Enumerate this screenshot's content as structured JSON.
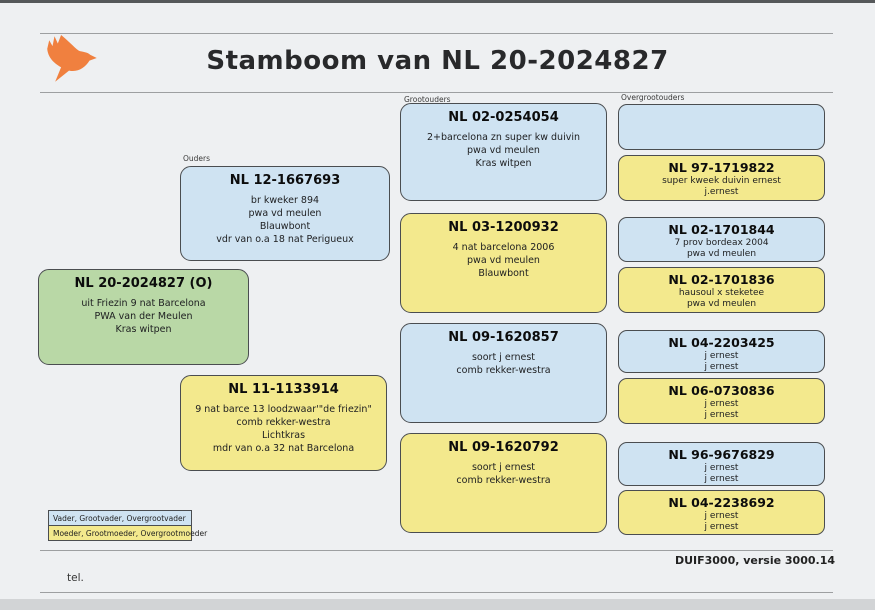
{
  "page": {
    "title": "Stamboom van NL 20-2024827",
    "footer_program": "DUIF3000, versie 3000.14",
    "footer_tel": "tel."
  },
  "column_labels": {
    "parents": "Ouders",
    "grandparents": "Grootouders",
    "great_grandparents": "Overgrootouders"
  },
  "colors": {
    "male_box": "#cfe3f2",
    "female_box": "#f3e98d",
    "subject_box": "#b9d8a6",
    "logo_orange": "#f0803f"
  },
  "subject": {
    "title": "NL 20-2024827 (O)",
    "lines": [
      "uit Friezin 9 nat Barcelona",
      "PWA van der Meulen",
      "Kras witpen"
    ]
  },
  "father": {
    "title": "NL 12-1667693",
    "lines": [
      "br kweker 894",
      "pwa vd meulen",
      "Blauwbont",
      "vdr van o.a 18 nat Perigueux"
    ]
  },
  "mother": {
    "title": "NL 11-1133914",
    "lines": [
      "9 nat barce 13 loodzwaar'\"de friezin\"",
      "comb rekker-westra",
      "Lichtkras",
      "mdr van o.a 32 nat Barcelona"
    ]
  },
  "grandparents": [
    {
      "title": "NL 02-0254054",
      "lines": [
        "2+barcelona zn super kw duivin",
        "pwa vd meulen",
        "Kras witpen"
      ]
    },
    {
      "title": "NL 03-1200932",
      "lines": [
        "4 nat barcelona 2006",
        "pwa vd meulen",
        "Blauwbont"
      ]
    },
    {
      "title": "NL 09-1620857",
      "lines": [
        "soort j ernest",
        "comb rekker-westra"
      ]
    },
    {
      "title": "NL 09-1620792",
      "lines": [
        "soort j ernest",
        "comb rekker-westra"
      ]
    }
  ],
  "great_grandparents": [
    {
      "title": "",
      "lines": []
    },
    {
      "title": "NL 97-1719822",
      "lines": [
        "super kweek duivin ernest",
        "j.ernest"
      ]
    },
    {
      "title": "NL 02-1701844",
      "lines": [
        "7 prov bordeax 2004",
        "pwa vd meulen"
      ]
    },
    {
      "title": "NL 02-1701836",
      "lines": [
        "hausoul x steketee",
        "pwa vd meulen"
      ]
    },
    {
      "title": "NL 04-2203425",
      "lines": [
        "j ernest",
        "j ernest"
      ]
    },
    {
      "title": "NL 06-0730836",
      "lines": [
        "j ernest",
        "j ernest"
      ]
    },
    {
      "title": "NL 96-9676829",
      "lines": [
        "j ernest",
        "j ernest"
      ]
    },
    {
      "title": "NL 04-2238692",
      "lines": [
        "j ernest",
        "j ernest"
      ]
    }
  ],
  "legend": {
    "male": "Vader, Grootvader, Overgrootvader",
    "female": "Moeder, Grootmoeder, Overgrootmoeder"
  }
}
